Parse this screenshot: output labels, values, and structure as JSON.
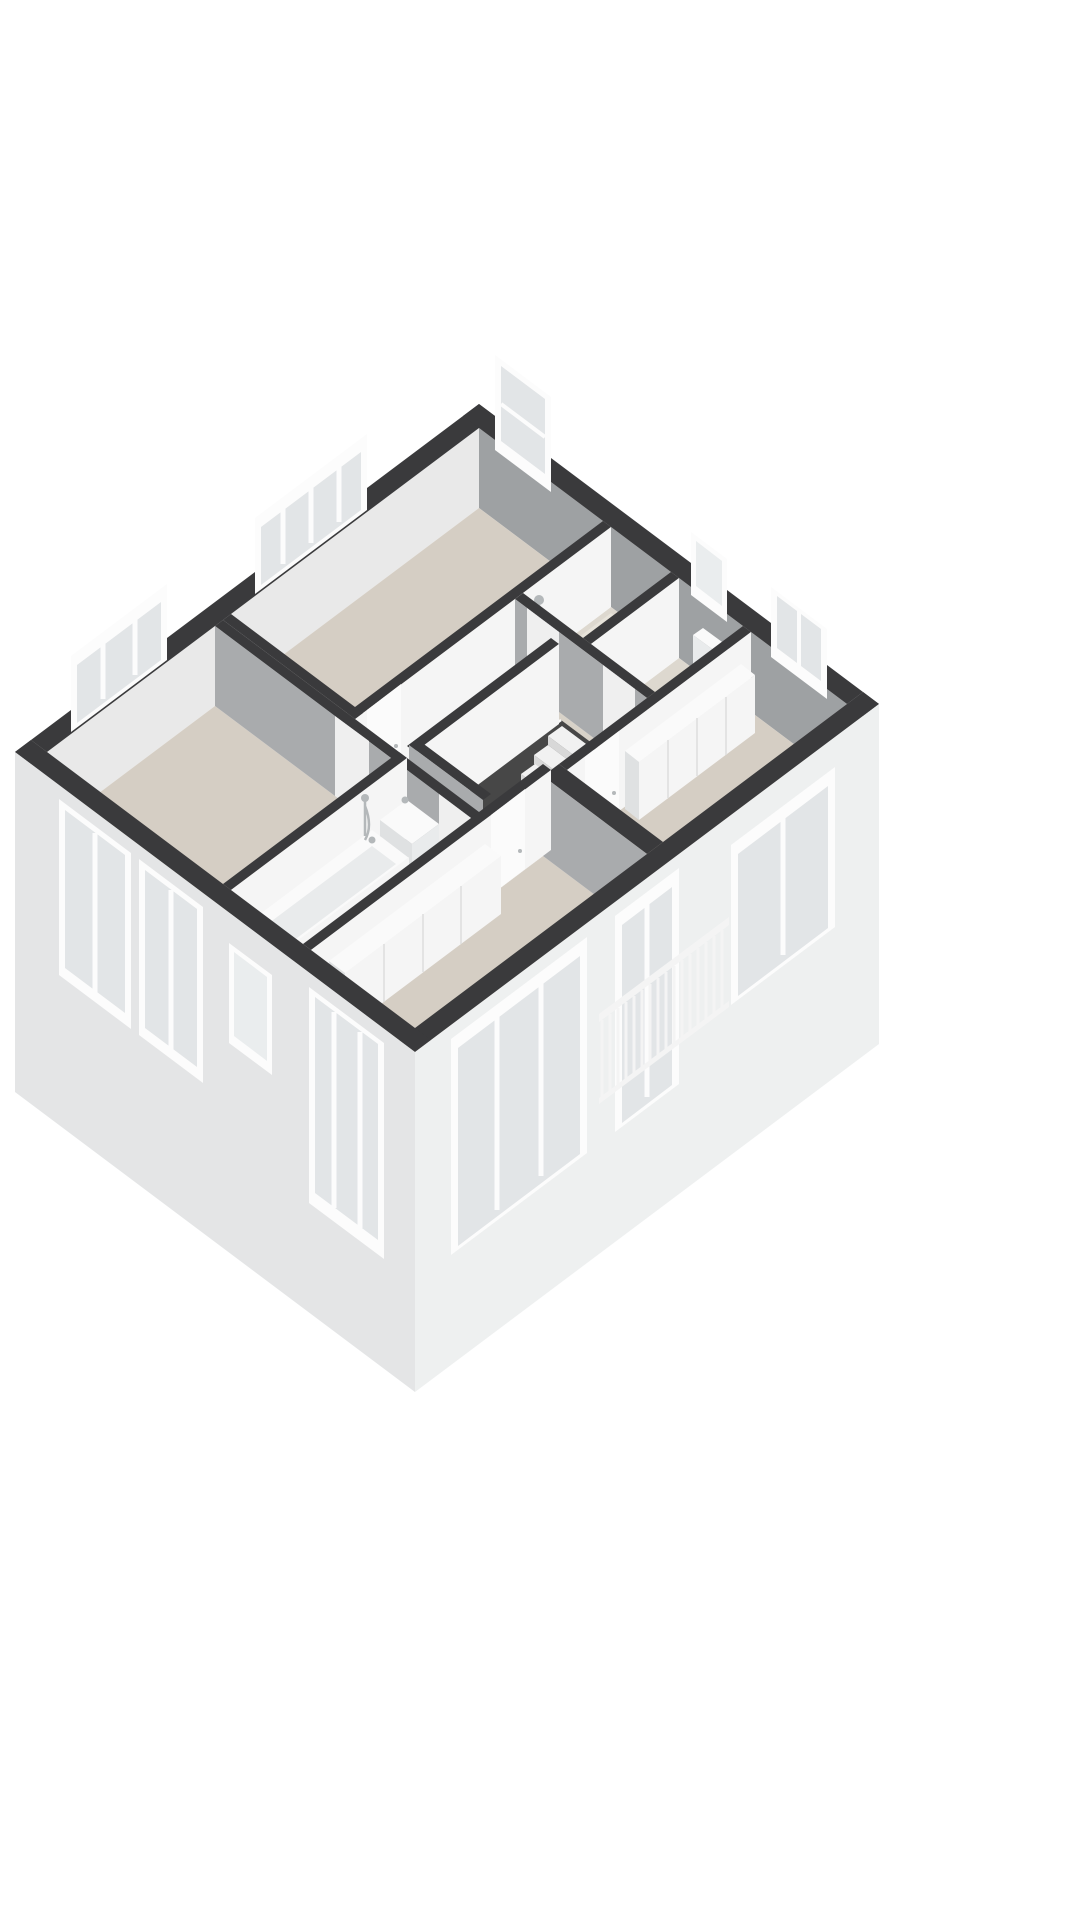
{
  "scene": {
    "kind": "3d-floorplan-cutaway-axonometric",
    "background": "#ffffff",
    "floor_label": "upper-floor",
    "wall_style": "dark-cut-top"
  },
  "palette": {
    "pageBg": "#ffffff",
    "wallTop": "#3a3a3c",
    "innerNW": "#e9e9e9",
    "innerNE": "#9ea1a3",
    "fillerSE": "#dcdddd",
    "fillerSW": "#cfd0d2",
    "faceSE": "#f5f5f5",
    "faceSW": "#a9abad",
    "facadeSE": "#eef0f0",
    "facadeSW": "#e4e5e6",
    "floorMain": "#d5cec4",
    "floorHall": "#d8d2c8",
    "floorWet": "#ddd8cf",
    "glass": "#e2e5e7",
    "glassFrost": "#eaedee",
    "frame": "#fcfcfc",
    "tread": "#f1f1f1",
    "riser": "#d8d8d8",
    "void": "#474747",
    "fixture": "#fafafa",
    "fixtureShade": "#e9ebec",
    "fixtureSide": "#dfe1e2",
    "chrome": "#b4b8ba",
    "seam": "#dddddd",
    "door": "#fbfbfb",
    "doorSW": "#efefef",
    "railing": "#f4f4f4",
    "cutEdge": "#c9c2b8",
    "trayWet": "#e7e3da"
  },
  "rooms": [
    {
      "id": "bedroom-north",
      "type": "bedroom",
      "floor_finish": "beige",
      "features": [
        "wide-window-nw",
        "tall-window-ne"
      ]
    },
    {
      "id": "shower-room",
      "type": "shower-room",
      "floor_finish": "wet",
      "features": [
        "hand-shower",
        "shower-tray"
      ]
    },
    {
      "id": "toilet-room",
      "type": "toilet",
      "floor_finish": "wet",
      "features": [
        "toilet",
        "small-window-ne"
      ]
    },
    {
      "id": "bedroom-east",
      "type": "bedroom",
      "floor_finish": "beige",
      "features": [
        "built-in-wardrobe",
        "window-ne",
        "window-se"
      ]
    },
    {
      "id": "bedroom-west",
      "type": "bedroom",
      "floor_finish": "beige",
      "features": [
        "window-nw",
        "two-windows-sw"
      ]
    },
    {
      "id": "bathroom",
      "type": "bathroom",
      "floor_finish": "wet",
      "features": [
        "bathtub",
        "hand-shower",
        "washbasin",
        "small-window-sw"
      ]
    },
    {
      "id": "bedroom-south",
      "type": "bedroom",
      "floor_finish": "beige",
      "features": [
        "built-in-wardrobe",
        "large-window-sw",
        "large-window-se",
        "french-balcony"
      ]
    },
    {
      "id": "landing",
      "type": "hall",
      "floor_finish": "beige-light",
      "features": [
        "staircase-opening",
        "doors-to-all-rooms"
      ]
    }
  ],
  "fixtures": [
    {
      "id": "bathtub",
      "room": "bathroom",
      "material": "white-acrylic",
      "tap": "chrome"
    },
    {
      "id": "washbasin",
      "room": "bathroom",
      "tap": "chrome"
    },
    {
      "id": "hand-shower-bathroom",
      "room": "bathroom",
      "material": "chrome"
    },
    {
      "id": "hand-shower",
      "room": "shower-room",
      "material": "chrome"
    },
    {
      "id": "toilet",
      "room": "toilet-room",
      "material": "ceramic-white"
    },
    {
      "id": "wardrobe-east",
      "room": "bedroom-east",
      "doors": 4
    },
    {
      "id": "wardrobe-south",
      "room": "bedroom-south",
      "doors": 4
    }
  ],
  "stairs": {
    "visible_steps": 10,
    "descends_toward": "southwest",
    "tread_color": "white"
  },
  "balcony_railing": {
    "location": "se-facade",
    "balusters": 16,
    "color": "white"
  },
  "window_counts": {
    "nw_facade": 2,
    "ne_facade": 3,
    "sw_facade": 4,
    "se_facade": 3
  }
}
